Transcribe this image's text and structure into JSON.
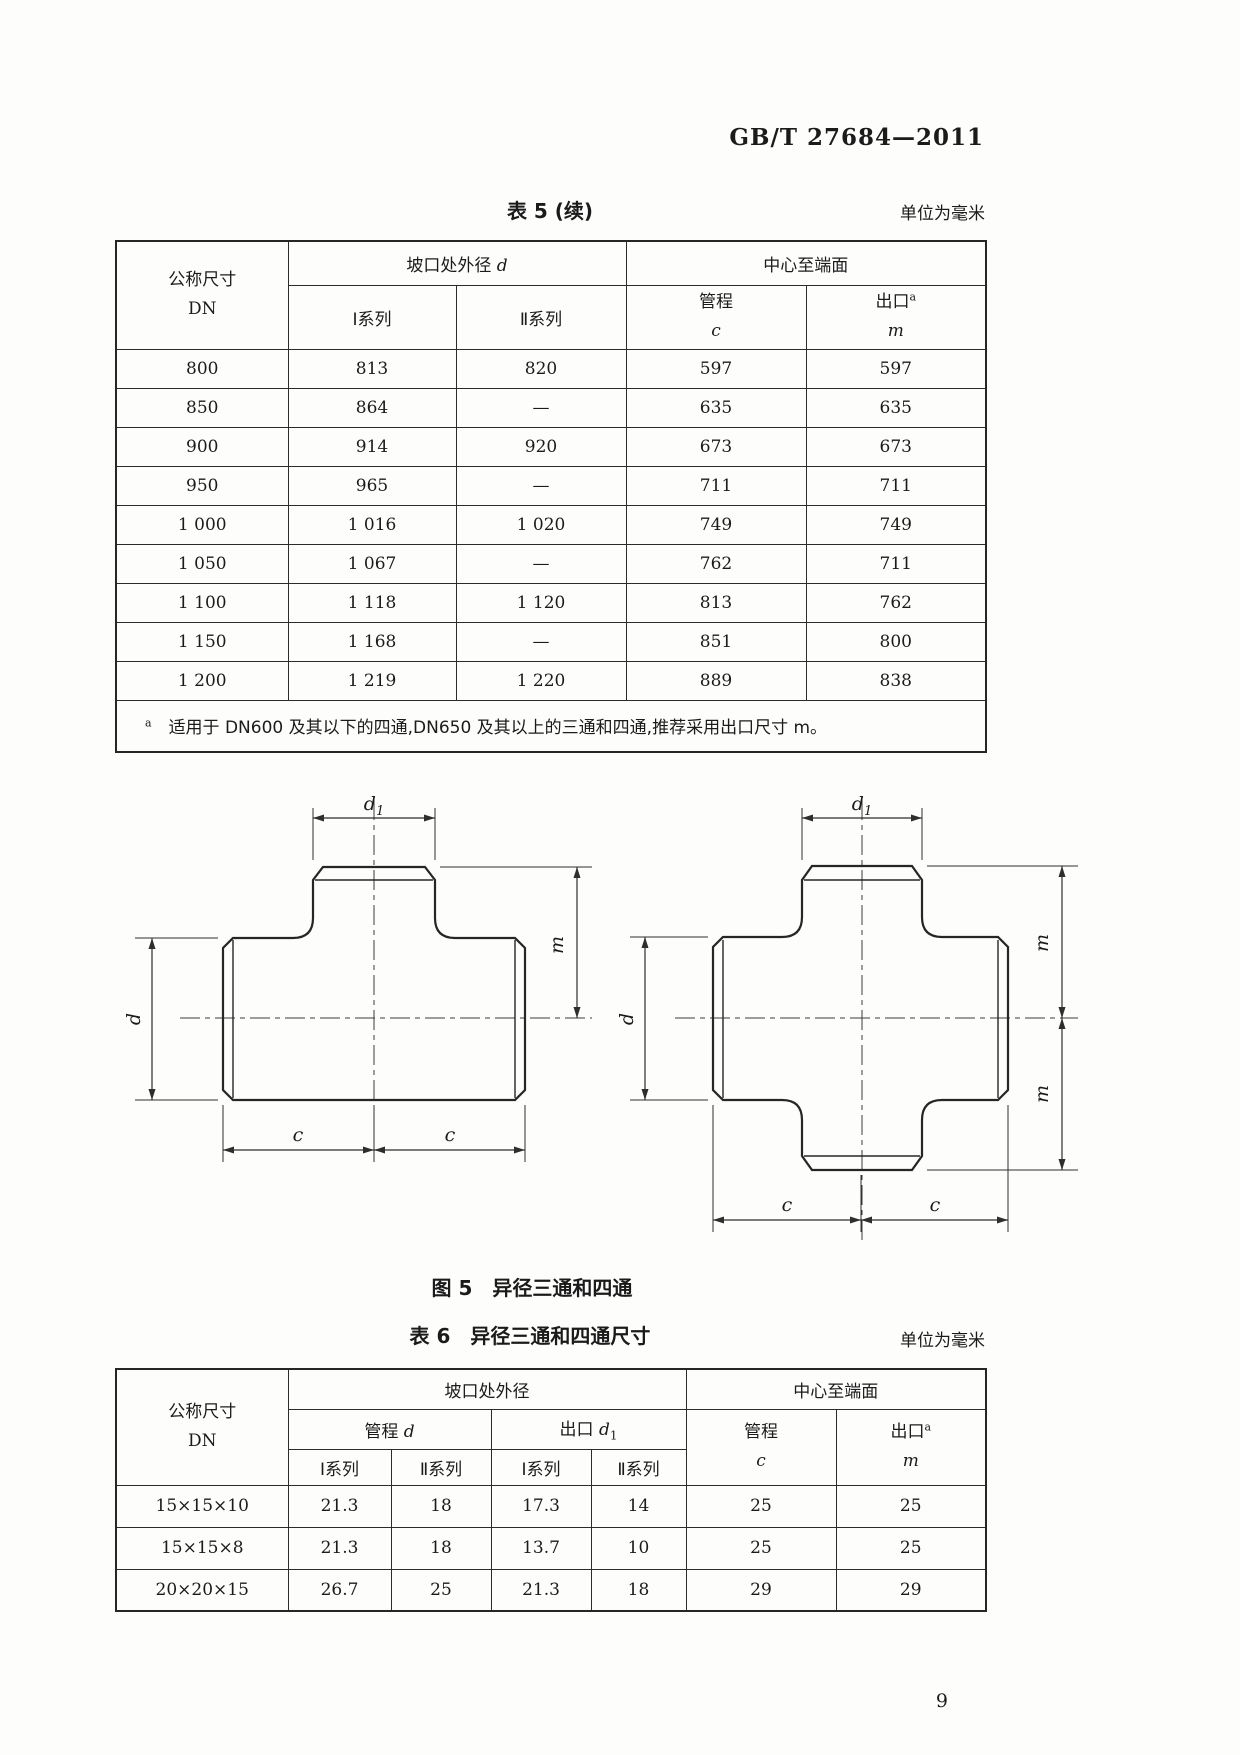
{
  "doc_number": "GB/T 27684—2011",
  "page_number": "9",
  "unit_note": "单位为毫米",
  "table5": {
    "title": "表 5 (续)",
    "headers": {
      "dn_line1": "公称尺寸",
      "dn_line2": "DN",
      "groove_od_text": "坡口处外径",
      "groove_od_sym": "d",
      "center_to_end": "中心至端面",
      "series1": "Ⅰ系列",
      "series2": "Ⅱ系列",
      "run_text": "管程",
      "run_sym": "c",
      "outlet_text": "出口",
      "outlet_sup": "a",
      "outlet_sym": "m"
    },
    "rows": [
      [
        "800",
        "813",
        "820",
        "597",
        "597"
      ],
      [
        "850",
        "864",
        "—",
        "635",
        "635"
      ],
      [
        "900",
        "914",
        "920",
        "673",
        "673"
      ],
      [
        "950",
        "965",
        "—",
        "711",
        "711"
      ],
      [
        "1 000",
        "1 016",
        "1 020",
        "749",
        "749"
      ],
      [
        "1 050",
        "1 067",
        "—",
        "762",
        "711"
      ],
      [
        "1 100",
        "1 118",
        "1 120",
        "813",
        "762"
      ],
      [
        "1 150",
        "1 168",
        "—",
        "851",
        "800"
      ],
      [
        "1 200",
        "1 219",
        "1 220",
        "889",
        "838"
      ]
    ],
    "footnote_sup": "a",
    "footnote_text": "适用于 DN600 及其以下的四通,DN650 及其以上的三通和四通,推荐采用出口尺寸 m。"
  },
  "figure5": {
    "caption": "图 5　异径三通和四通",
    "labels": {
      "d1_main": "d",
      "d1_sub": "1",
      "m": "m",
      "d": "d",
      "c": "c"
    }
  },
  "table6": {
    "title": "表 6　异径三通和四通尺寸",
    "headers": {
      "dn_line1": "公称尺寸",
      "dn_line2": "DN",
      "groove_od": "坡口处外径",
      "center_to_end": "中心至端面",
      "run_d_text": "管程",
      "run_d_sym": "d",
      "outlet_d_text": "出口",
      "outlet_d_sym": "d",
      "outlet_d_sub": "1",
      "series1": "Ⅰ系列",
      "series2": "Ⅱ系列",
      "run_text": "管程",
      "run_sym": "c",
      "outlet_text": "出口",
      "outlet_sup": "a",
      "outlet_sym": "m"
    },
    "rows": [
      [
        "15×15×10",
        "21.3",
        "18",
        "17.3",
        "14",
        "25",
        "25"
      ],
      [
        "15×15×8",
        "21.3",
        "18",
        "13.7",
        "10",
        "25",
        "25"
      ],
      [
        "20×20×15",
        "26.7",
        "25",
        "21.3",
        "18",
        "29",
        "29"
      ]
    ]
  }
}
